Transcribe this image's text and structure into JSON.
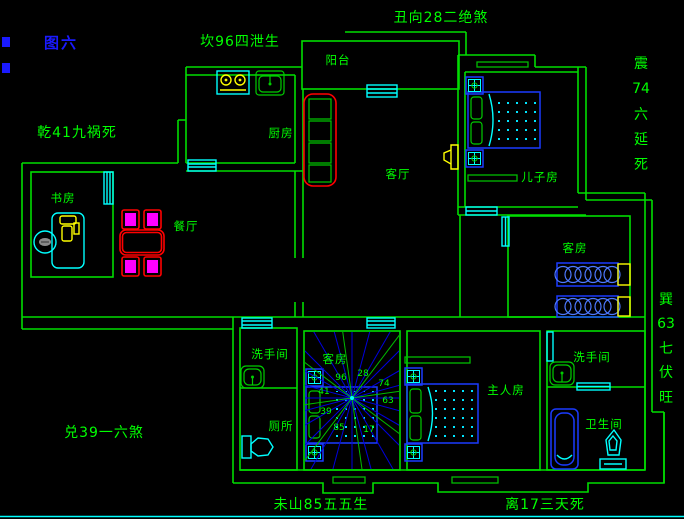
{
  "figure_label": "图六",
  "directions": {
    "top": "丑向28二绝煞",
    "north": "坎96四泄生",
    "northwest": "乾41九祸死",
    "west": "兑39一六煞",
    "south_left": "未山85五五生",
    "south_right": "离17三天死",
    "east": [
      "震",
      "74",
      "六",
      "延",
      "死"
    ],
    "southeast": [
      "巽",
      "63",
      "七",
      "伏",
      "旺"
    ]
  },
  "rooms": {
    "balcony": "阳台",
    "kitchen": "厨房",
    "living_room": "客厅",
    "son_room": "儿子房",
    "study": "书房",
    "dining": "餐厅",
    "guest_room_east": "客房",
    "guest_room_center": "客房",
    "washroom_center": "洗手间",
    "toilet": "厕所",
    "master_room": "主人房",
    "washroom_east": "洗手间",
    "bathroom": "卫生间"
  },
  "compass_numbers": [
    "96",
    "28",
    "74",
    "63",
    "17",
    "85",
    "39",
    "41"
  ],
  "colors": {
    "background": "#000000",
    "wall_green": "#00dd00",
    "text_green": "#00ff00",
    "figure_blue": "#1a1aff",
    "furniture_blue": "#1a3aff",
    "fixture_cyan": "#00ffff",
    "accent_yellow": "#ffff00",
    "accent_red": "#ff0000",
    "accent_magenta": "#ff00ff"
  }
}
